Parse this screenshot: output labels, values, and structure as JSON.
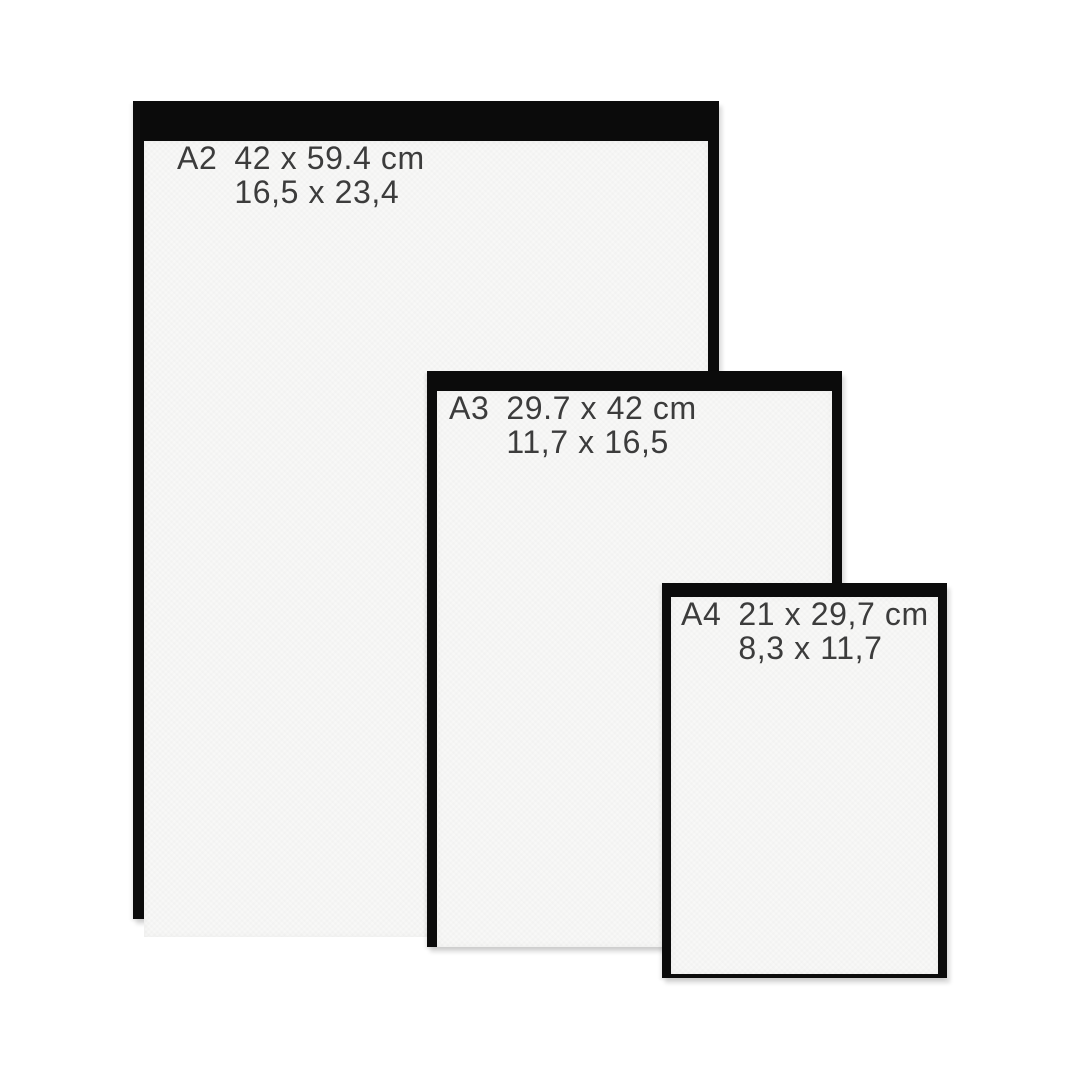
{
  "frames": [
    {
      "code": "A2",
      "metric": "42 x 59.4 cm",
      "imperial": "16,5 x 23,4"
    },
    {
      "code": "A3",
      "metric": "29.7 x 42 cm",
      "imperial": "11,7 x 16,5"
    },
    {
      "code": "A4",
      "metric": "21 x 29,7 cm",
      "imperial": "8,3 x 11,7"
    }
  ],
  "colors": {
    "background": "#ffffff",
    "frame_border": "#0b0b0b",
    "paper": "#f8f8f7",
    "text": "#3c3c3c"
  }
}
